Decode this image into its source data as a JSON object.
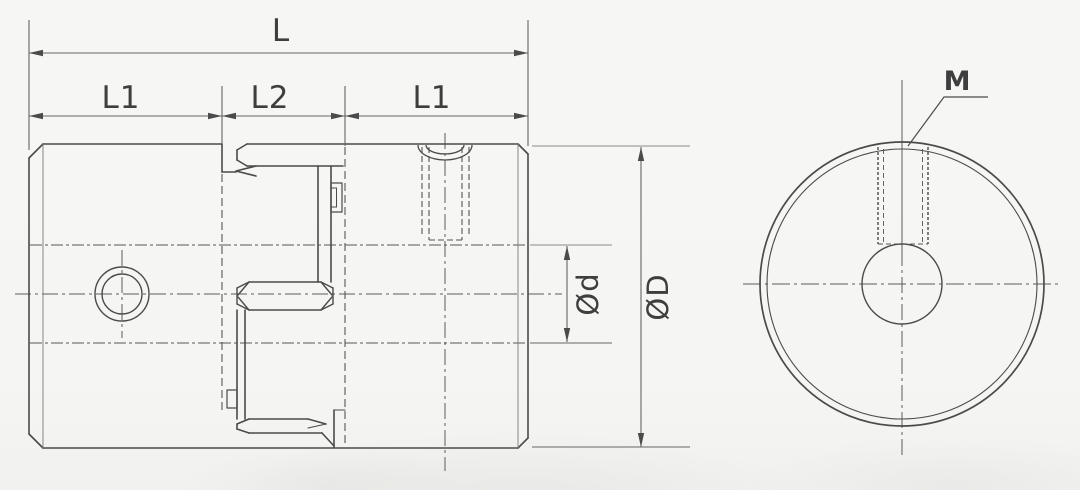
{
  "drawing": {
    "kind": "technical dimensional drawing, shaft coupling (side section view and front view)",
    "labels": {
      "overall_length": "L",
      "left_hub_length": "L1",
      "center_length": "L2",
      "right_hub_length": "L1",
      "bore_diameter": "Ød",
      "outer_diameter": "ØD",
      "thread": "M"
    },
    "colors": {
      "paper": "#f5f5f3",
      "line": "#4b4b4b",
      "thin_line": "#6b6b6b",
      "text": "#3e3e3e"
    }
  }
}
